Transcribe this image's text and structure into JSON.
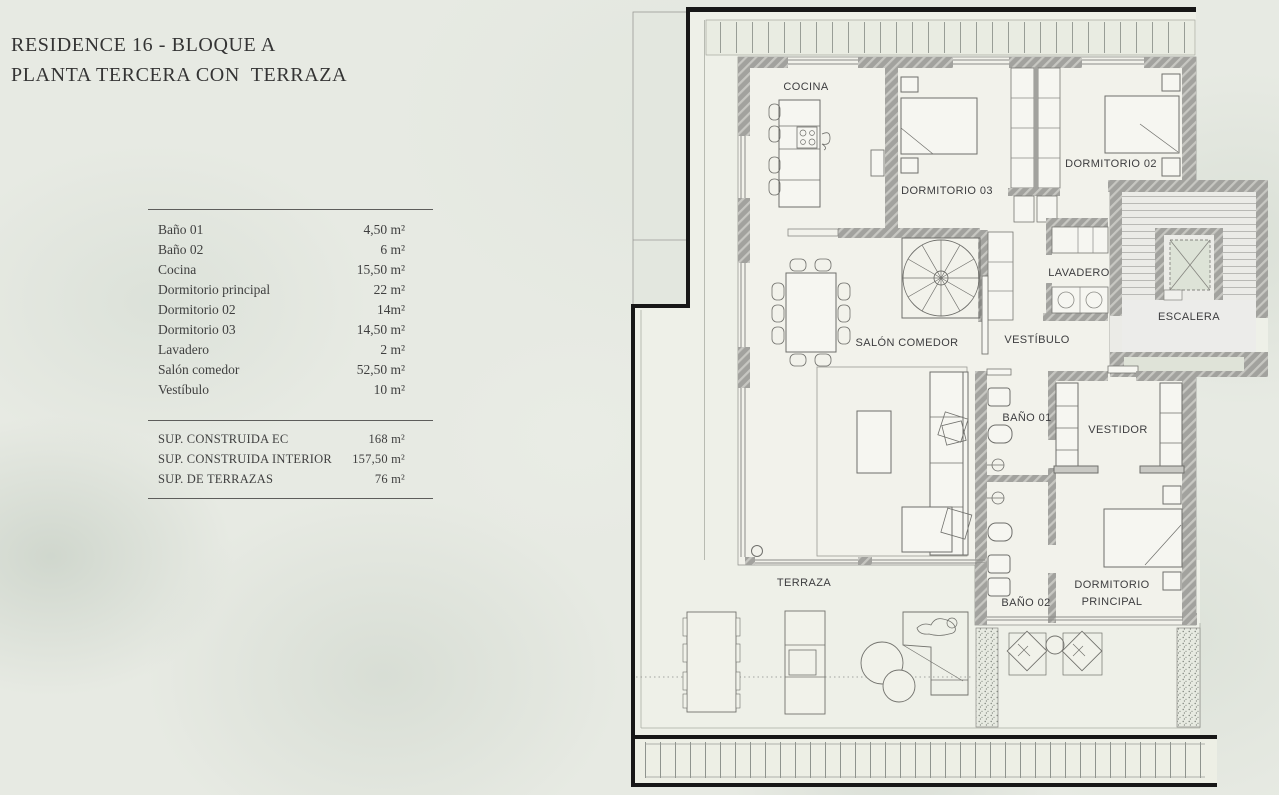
{
  "panel": {
    "title_line1": "RESIDENCE 16 - BLOQUE A",
    "title_line2": "PLANTA TERCERA CON  TERRAZA",
    "rooms": [
      {
        "label": "Baño 01",
        "area": "4,50 m²"
      },
      {
        "label": "Baño 02",
        "area": "6 m²"
      },
      {
        "label": "Cocina",
        "area": "15,50 m²"
      },
      {
        "label": "Dormitorio principal",
        "area": "22 m²"
      },
      {
        "label": "Dormitorio 02",
        "area": "14m²"
      },
      {
        "label": "Dormitorio 03",
        "area": "14,50 m²"
      },
      {
        "label": "Lavadero",
        "area": "2 m²"
      },
      {
        "label": "Salón comedor",
        "area": "52,50 m²"
      },
      {
        "label": "Vestíbulo",
        "area": "10 m²"
      }
    ],
    "totals": [
      {
        "label": "SUP. CONSTRUIDA EC",
        "area": "168 m²"
      },
      {
        "label": "SUP. CONSTRUIDA INTERIOR",
        "area": "157,50 m²"
      },
      {
        "label": "SUP. DE TERRAZAS",
        "area": "76 m²"
      }
    ]
  },
  "plan": {
    "room_labels": {
      "cocina": "COCINA",
      "dormitorio03": "DORMITORIO 03",
      "dormitorio02": "DORMITORIO 02",
      "lavadero": "LAVADERO",
      "escalera": "ESCALERA",
      "salon_comedor": "SALÓN COMEDOR",
      "vestibulo": "VESTÍBULO",
      "bano01": "BAÑO 01",
      "vestidor": "VESTIDOR",
      "bano02": "BAÑO 02",
      "dorm_principal_line1": "DORMITORIO",
      "dorm_principal_line2": "PRINCIPAL",
      "terraza": "TERRAZA"
    },
    "colors": {
      "background": "#e7eae3",
      "apartment_floor": "#f2f2eb",
      "terrace_floor": "#eef0e8",
      "wall": "#a2a29e",
      "outline_black": "#171717",
      "label_text": "#3d3d3f"
    }
  }
}
